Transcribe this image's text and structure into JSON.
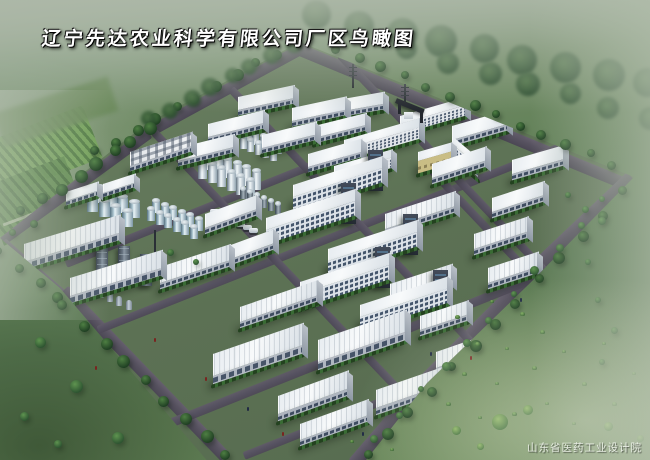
{
  "title": "辽宁先达农业科学有限公司厂区鸟瞰图",
  "watermark": "山东省医药工业设计院",
  "palette": {
    "road": "#55505e",
    "roof": "#f2f5f7",
    "grass": "#5f7e55",
    "tree_dark": "#1e3d22",
    "solar_blue": "#25355c",
    "courtyard_tan": "#d2c795"
  },
  "scene": {
    "roads": [
      [
        150,
        131,
        178,
        -28.6,
        11,
        "b"
      ],
      [
        2,
        240,
        182,
        -36.1,
        11,
        "b"
      ],
      [
        300,
        50,
        348,
        22.4,
        12,
        "b"
      ],
      [
        522,
        281,
        151,
        -43.4,
        14,
        "b"
      ],
      [
        424,
        382,
        141,
        -45,
        14,
        "b"
      ],
      [
        354,
        464,
        110,
        -49.4,
        14,
        "b"
      ],
      [
        2,
        242,
        88,
        41.2,
        11,
        "b"
      ],
      [
        64,
        290,
        232,
        46,
        12,
        "b"
      ],
      [
        66,
        264,
        445,
        -21.8,
        8,
        "i"
      ],
      [
        98,
        330,
        500,
        -21.6,
        8,
        "i"
      ],
      [
        152,
        430,
        480,
        -21.7,
        9,
        "i"
      ],
      [
        244,
        456,
        280,
        -21.6,
        8,
        "i"
      ],
      [
        154,
        132,
        350,
        46.5,
        8,
        "i"
      ],
      [
        231,
        89,
        380,
        46.5,
        8,
        "i"
      ],
      [
        340,
        55,
        390,
        46.5,
        8,
        "i"
      ],
      [
        420,
        158,
        230,
        46.5,
        8,
        "i"
      ]
    ],
    "buildings": [
      [
        178,
        148,
        56,
        13,
        6,
        "wh",
        -14
      ],
      [
        208,
        124,
        56,
        13,
        6,
        "wh",
        -14
      ],
      [
        238,
        97,
        56,
        13,
        6,
        "wh",
        -12
      ],
      [
        262,
        135,
        54,
        13,
        6,
        "wh",
        -14
      ],
      [
        292,
        108,
        54,
        13,
        6,
        "wh",
        -12
      ],
      [
        326,
        102,
        58,
        12,
        6,
        "wh",
        -10
      ],
      [
        314,
        126,
        52,
        12,
        6,
        "wh",
        -14
      ],
      [
        308,
        154,
        54,
        13,
        6,
        "wh",
        -16
      ],
      [
        452,
        126,
        56,
        14,
        7,
        "wh",
        -16
      ],
      [
        512,
        160,
        52,
        14,
        7,
        "wh",
        -16
      ],
      [
        432,
        164,
        54,
        14,
        7,
        "wh",
        -18
      ],
      [
        492,
        198,
        52,
        14,
        7,
        "wh",
        -18
      ],
      [
        474,
        234,
        54,
        15,
        7,
        "whr",
        -18
      ],
      [
        488,
        268,
        50,
        15,
        7,
        "whr",
        -18
      ],
      [
        390,
        284,
        62,
        15,
        7,
        "whr",
        -18
      ],
      [
        420,
        316,
        48,
        14,
        7,
        "whr",
        -18
      ],
      [
        205,
        214,
        52,
        14,
        7,
        "wh",
        -20
      ],
      [
        228,
        246,
        46,
        14,
        7,
        "wh",
        -20
      ],
      [
        66,
        192,
        32,
        9,
        5,
        "wh",
        -18
      ],
      [
        103,
        184,
        32,
        9,
        5,
        "wh",
        -18
      ],
      [
        130,
        152,
        62,
        14,
        6,
        "hvac",
        -18
      ],
      [
        293,
        185,
        90,
        12,
        15,
        "ms",
        -18
      ],
      [
        266,
        218,
        90,
        12,
        15,
        "ms",
        -18
      ],
      [
        328,
        249,
        90,
        12,
        15,
        "ms",
        -18
      ],
      [
        300,
        282,
        90,
        12,
        15,
        "ms",
        -18
      ],
      [
        360,
        305,
        88,
        12,
        15,
        "ms",
        -18
      ],
      [
        385,
        214,
        70,
        15,
        7,
        "whr",
        -18
      ],
      [
        24,
        244,
        96,
        18,
        8,
        "big",
        -17
      ],
      [
        70,
        278,
        92,
        18,
        8,
        "big",
        -17
      ],
      [
        160,
        267,
        70,
        16,
        7,
        "whr",
        -18
      ],
      [
        240,
        307,
        78,
        15,
        7,
        "whr",
        -19
      ],
      [
        213,
        354,
        90,
        22,
        9,
        "big",
        -19
      ],
      [
        318,
        340,
        88,
        22,
        9,
        "big",
        -19
      ],
      [
        278,
        396,
        70,
        18,
        8,
        "whr",
        -20
      ],
      [
        376,
        390,
        66,
        18,
        8,
        "whr",
        -19
      ],
      [
        436,
        352,
        62,
        16,
        8,
        "whr",
        -19
      ],
      [
        300,
        424,
        68,
        16,
        7,
        "whr",
        -20
      ],
      [
        400,
        116,
        66,
        8,
        11,
        "off",
        -16
      ],
      [
        344,
        140,
        76,
        9,
        12,
        "off",
        -16
      ],
      [
        334,
        166,
        58,
        8,
        11,
        "off",
        -16
      ],
      [
        418,
        152,
        34,
        9,
        13,
        "tan",
        -16
      ],
      [
        452,
        136,
        26,
        8,
        11,
        "offb",
        40
      ]
    ],
    "tank_groups": [
      [
        204,
        150,
        2,
        6,
        9,
        20,
        9.5,
        4,
        -6,
        9,
        "steel"
      ],
      [
        237,
        126,
        2,
        6,
        7,
        13,
        7.5,
        3,
        -5,
        7,
        "steel"
      ],
      [
        94,
        186,
        2,
        4,
        11,
        17,
        11.5,
        5,
        -7,
        9,
        "blue"
      ],
      [
        152,
        200,
        2,
        6,
        8,
        13,
        8.5,
        3.5,
        -5,
        8,
        "blue"
      ],
      [
        240,
        188,
        1,
        6,
        6,
        11,
        7,
        3,
        0,
        0,
        "dark"
      ]
    ],
    "trucks": {
      "x": 210,
      "y": 209,
      "n": 7,
      "dx": 6.5,
      "dy": 3.2
    },
    "solar": {
      "x": 170,
      "y": 106,
      "w": 80,
      "h": 42,
      "sk": -18
    },
    "equipment": {
      "x": 88,
      "y": 236,
      "w": 74,
      "h": 48,
      "sk": -18,
      "towers": [
        [
          96,
          238
        ],
        [
          118,
          246
        ],
        [
          140,
          254
        ]
      ],
      "drums": [
        [
          98,
          288
        ],
        [
          107,
          292
        ],
        [
          116,
          296
        ],
        [
          126,
          300
        ]
      ],
      "mast": [
        154,
        230
      ]
    },
    "canopy": {
      "x": 176,
      "y": 268,
      "w": 36,
      "h": 13,
      "sk": -18
    },
    "courtyard": {
      "x": 362,
      "y": 144,
      "w": 58,
      "h": 26,
      "sk": -16
    },
    "pond": {
      "x": 388,
      "y": 152,
      "w": 13,
      "h": 8
    },
    "gate": {
      "x": 396,
      "y": 98
    },
    "masts": [
      [
        352,
        64,
        24
      ],
      [
        404,
        84,
        20
      ]
    ],
    "tree_rows": [
      [
        312,
        38,
        612,
        164,
        14,
        9,
        0
      ],
      [
        318,
        16,
        648,
        84,
        9,
        30,
        3
      ],
      [
        408,
        50,
        650,
        118,
        7,
        22,
        3
      ],
      [
        96,
        152,
        296,
        42,
        11,
        10,
        0
      ],
      [
        150,
        120,
        292,
        44,
        8,
        16,
        3
      ],
      [
        44,
        200,
        150,
        128,
        7,
        12,
        0
      ],
      [
        624,
        192,
        366,
        456,
        13,
        10,
        0
      ],
      [
        604,
        200,
        376,
        438,
        11,
        7,
        1
      ],
      [
        0,
        252,
        58,
        298,
        4,
        9,
        0
      ],
      [
        64,
        306,
        226,
        456,
        9,
        11,
        0
      ],
      [
        570,
        196,
        600,
        220,
        3,
        7,
        1
      ]
    ],
    "trees": [
      [
        40,
        342,
        11,
        1
      ],
      [
        76,
        386,
        13,
        1
      ],
      [
        24,
        416,
        9,
        1
      ],
      [
        118,
        438,
        12,
        1
      ],
      [
        58,
        444,
        8,
        1
      ],
      [
        500,
        422,
        16,
        2
      ],
      [
        528,
        410,
        10,
        2
      ],
      [
        456,
        430,
        9,
        2
      ],
      [
        608,
        426,
        9,
        2
      ],
      [
        640,
        438,
        7,
        2
      ],
      [
        566,
        446,
        8,
        2
      ],
      [
        480,
        446,
        7,
        2
      ],
      [
        20,
        210,
        9,
        0
      ],
      [
        34,
        224,
        8,
        0
      ],
      [
        12,
        232,
        7,
        0
      ],
      [
        598,
        300,
        6,
        1
      ],
      [
        614,
        330,
        7,
        1
      ],
      [
        602,
        362,
        6,
        1
      ],
      [
        588,
        262,
        6,
        1
      ],
      [
        170,
        252,
        7,
        1
      ],
      [
        196,
        262,
        6,
        1
      ]
    ],
    "shrubs": [
      [
        455,
        315,
        5
      ],
      [
        490,
        300,
        4
      ],
      [
        520,
        312,
        5
      ],
      [
        475,
        342,
        5
      ],
      [
        505,
        347,
        4
      ],
      [
        540,
        330,
        5
      ],
      [
        462,
        372,
        5
      ],
      [
        495,
        382,
        4
      ],
      [
        532,
        366,
        5
      ],
      [
        562,
        350,
        4
      ],
      [
        582,
        382,
        5
      ],
      [
        545,
        402,
        4
      ],
      [
        512,
        412,
        5
      ],
      [
        572,
        422,
        4
      ],
      [
        612,
        402,
        5
      ],
      [
        632,
        372,
        4
      ],
      [
        602,
        342,
        4
      ],
      [
        478,
        416,
        4
      ],
      [
        446,
        402,
        5
      ],
      [
        350,
        440,
        4
      ],
      [
        390,
        448,
        4
      ]
    ],
    "people": [
      [
        205,
        377,
        "#7a2420"
      ],
      [
        247,
        407,
        "#202a44"
      ],
      [
        282,
        432,
        "#7a2420"
      ],
      [
        430,
        352,
        "#202a44"
      ],
      [
        470,
        356,
        "#7a2420"
      ],
      [
        520,
        298,
        "#202a44"
      ],
      [
        154,
        338,
        "#7a2420"
      ],
      [
        362,
        432,
        "#202a44"
      ],
      [
        95,
        366,
        "#7a2420"
      ]
    ]
  }
}
